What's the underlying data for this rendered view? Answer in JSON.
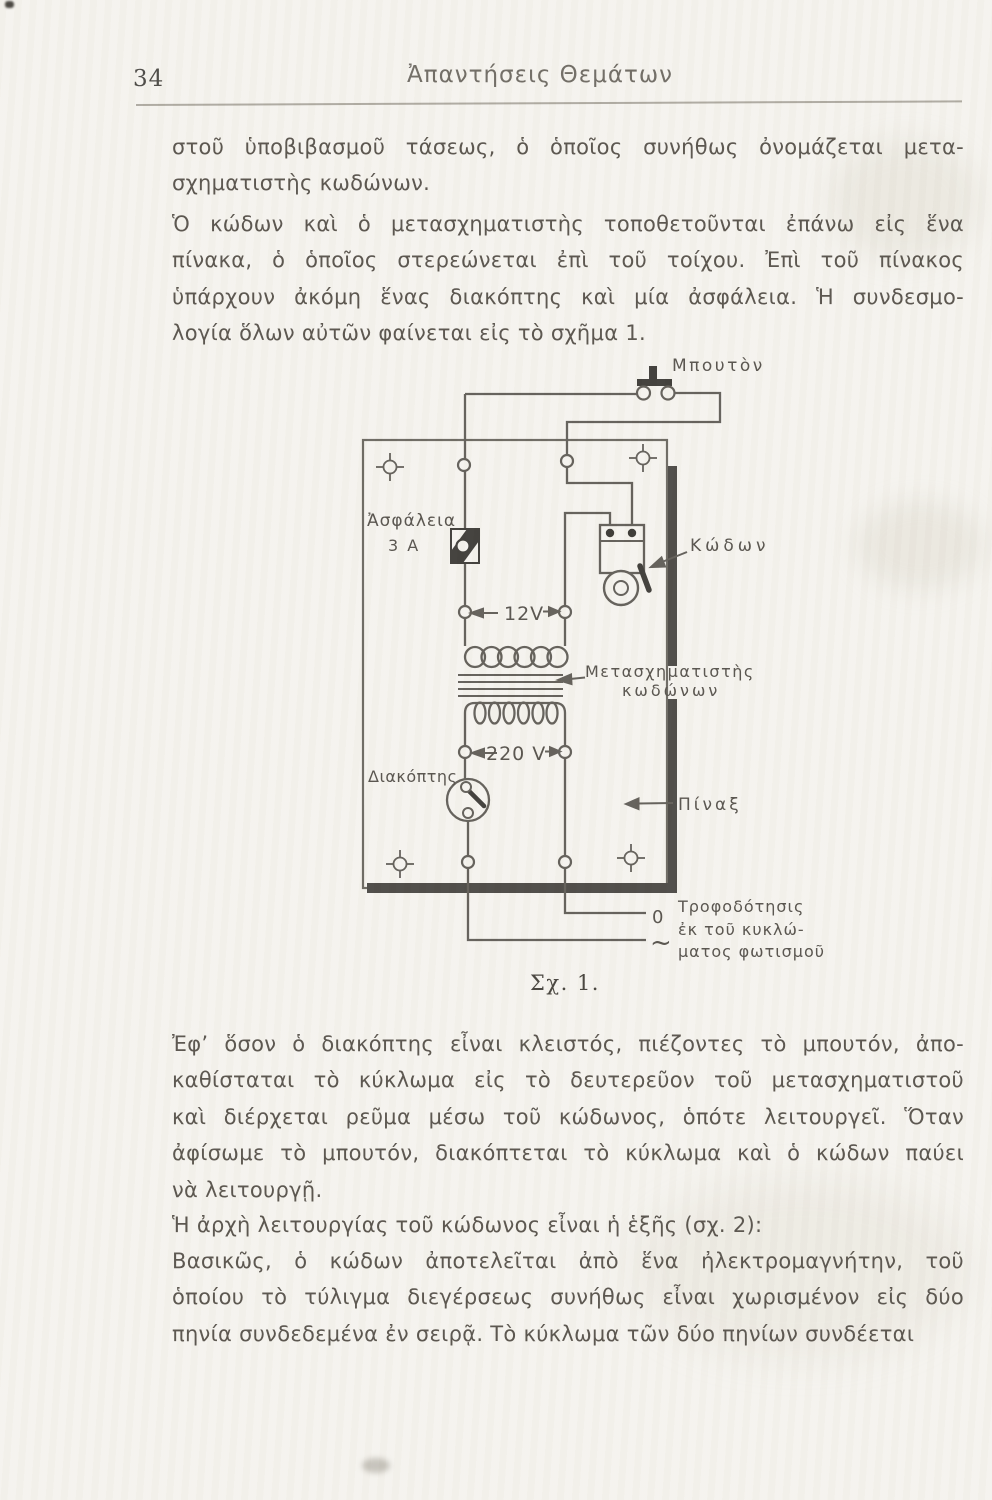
{
  "page": {
    "number": "34",
    "header": "Ἀπαντήσεις Θεμάτων"
  },
  "paragraphs": {
    "p1": [
      "στοῦ ὑποβιβασμοῦ τάσεως, ὁ ὁποῖος συνήθως ὀνομάζεται μετα-",
      "σχηματιστὴς κωδώνων."
    ],
    "p2": [
      "Ὁ κώδων καὶ ὁ μετασχηματιστὴς τοποθετοῦνται ἐπάνω εἰς ἕνα",
      "πίνακα, ὁ ὁποῖος στερεώνεται ἐπὶ τοῦ τοίχου. Ἐπὶ τοῦ πίνακος",
      "ὑπάρχουν ἀκόμη ἕνας διακόπτης καὶ μία ἀσφάλεια. Ἡ συνδεσμο-",
      "λογία ὅλων αὐτῶν φαίνεται εἰς τὸ σχῆμα 1."
    ],
    "p3": [
      "Ἐφ’ ὅσον ὁ διακόπτης εἶναι κλειστός, πιέζοντες τὸ μπουτόν, ἀπο-",
      "καθίσταται τὸ κύκλωμα εἰς τὸ δευτερεῦον τοῦ μετασχηματιστοῦ",
      "καὶ διέρχεται ρεῦμα μέσω τοῦ κώδωνος, ὁπότε λειτουργεῖ. Ὅταν",
      "ἀφίσωμε τὸ μπουτόν, διακόπτεται τὸ κύκλωμα καὶ ὁ κώδων παύει",
      "νὰ λειτουργῇ."
    ],
    "p4": [
      "Ἡ ἀρχὴ λειτουργίας τοῦ κώδωνος εἶναι ἡ ἑξῆς (σχ. 2):"
    ],
    "p5": [
      "Βασικῶς, ὁ κώδων ἀποτελεῖται ἀπὸ ἕνα ἠλεκτρομαγνήτην, τοῦ",
      "ὁποίου τὸ τύλιγμα διεγέρσεως συνήθως εἶναι χωρισμένον εἰς δύο",
      "πηνία συνδεδεμένα ἐν σειρᾷ. Τὸ κύκλωμα τῶν δύο πηνίων συνδέεται"
    ]
  },
  "figure": {
    "caption": "Σχ. 1.",
    "labels": {
      "button": "Μπουτὸν",
      "fuse1": "Ἀσφάλεια",
      "fuse2": "3 A",
      "secondary_voltage": "12V",
      "primary_voltage": "220 V",
      "bell": "Κώδων",
      "transformer1": "Μετασχηματιστὴς",
      "transformer2": "κωδώνων",
      "switch": "Διακόπτης",
      "panel": "Πίναξ",
      "terminal_zero": "0",
      "terminal_phase": "~",
      "supply1": "Τροφοδότησις",
      "supply2": "ἐκ τοῦ κυκλώ-",
      "supply3": "ματος φωτισμοῦ"
    }
  }
}
